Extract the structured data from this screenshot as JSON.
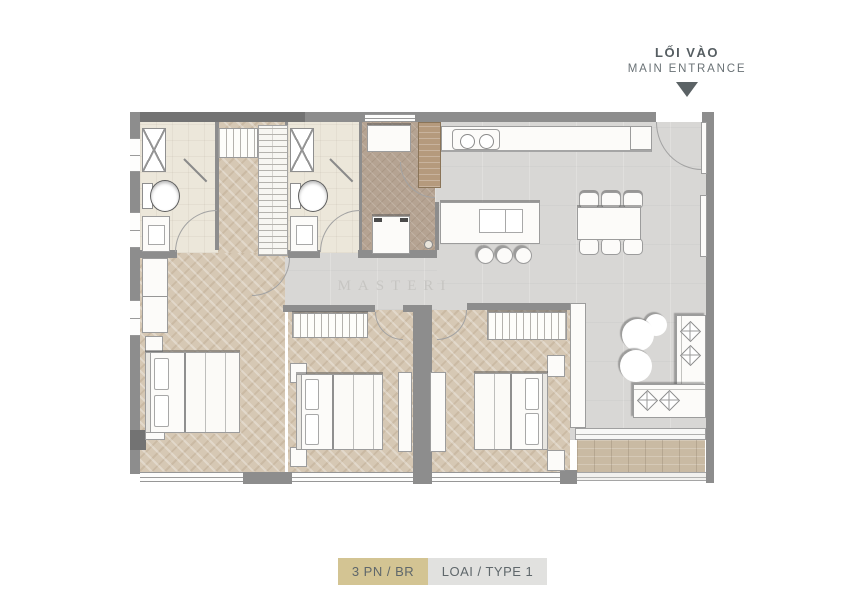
{
  "entrance": {
    "label_vi": "LỐI VÀO",
    "label_en": "MAIN ENTRANCE",
    "arrow_icon": "triangle-down-icon"
  },
  "legend": {
    "bedrooms": "3 PN / BR",
    "type": "LOAI / TYPE 1"
  },
  "watermark": "MASTERI",
  "plan": {
    "rooms": [
      "bathroom-1",
      "bathroom-2",
      "utility-room",
      "kitchen",
      "dining-area",
      "living-room",
      "bedroom-1",
      "bedroom-2",
      "master-bedroom",
      "corridor",
      "balcony"
    ],
    "symbols": [
      "shower-icon",
      "shower-head-icon",
      "toilet-icon",
      "vanity-sink-icon",
      "washing-machine-icon",
      "cooktop-icon",
      "kitchen-sink-icon",
      "door-swing-icon",
      "bar-stool-icon",
      "dining-chair-icon",
      "coffee-table-icon",
      "sofa-icon",
      "bed-icon",
      "wardrobe-icon",
      "shelf-unit-icon",
      "floor-drain-icon"
    ]
  },
  "colors": {
    "legend_tan": "#d3c493",
    "legend_gray": "#e1e1df",
    "text": "#5f676b",
    "wall": "#8d8d8d",
    "wood_floor": "#d6c8b4",
    "tile_gray": "#d8d7d5",
    "bath_floor": "#ece7da",
    "utility_floor": "#b5a392",
    "deck": "#c9baa3"
  }
}
